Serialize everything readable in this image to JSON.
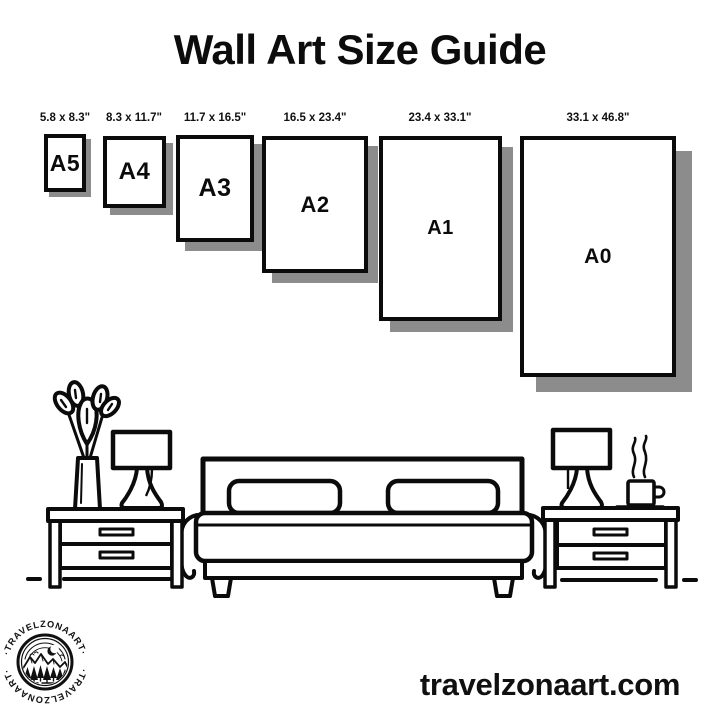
{
  "title": "Wall Art Size Guide",
  "size_guide": {
    "sizes": [
      {
        "label": "A5",
        "dimensions": "5.8 x 8.3\""
      },
      {
        "label": "A4",
        "dimensions": "8.3 x 11.7\""
      },
      {
        "label": "A3",
        "dimensions": "11.7 x 16.5\""
      },
      {
        "label": "A2",
        "dimensions": "16.5 x 23.4\""
      },
      {
        "label": "A1",
        "dimensions": "23.4 x 33.1\""
      },
      {
        "label": "A0",
        "dimensions": "33.1 x 46.8\""
      }
    ]
  },
  "logo": {
    "brand": "TRAVELZONAART",
    "arc_text": "·TRAVELZONAART·"
  },
  "footer": {
    "website": "travelzonaart.com"
  },
  "colors": {
    "line": "#0b0b0b",
    "shadow": "#8c8c8c",
    "background": "#ffffff"
  }
}
